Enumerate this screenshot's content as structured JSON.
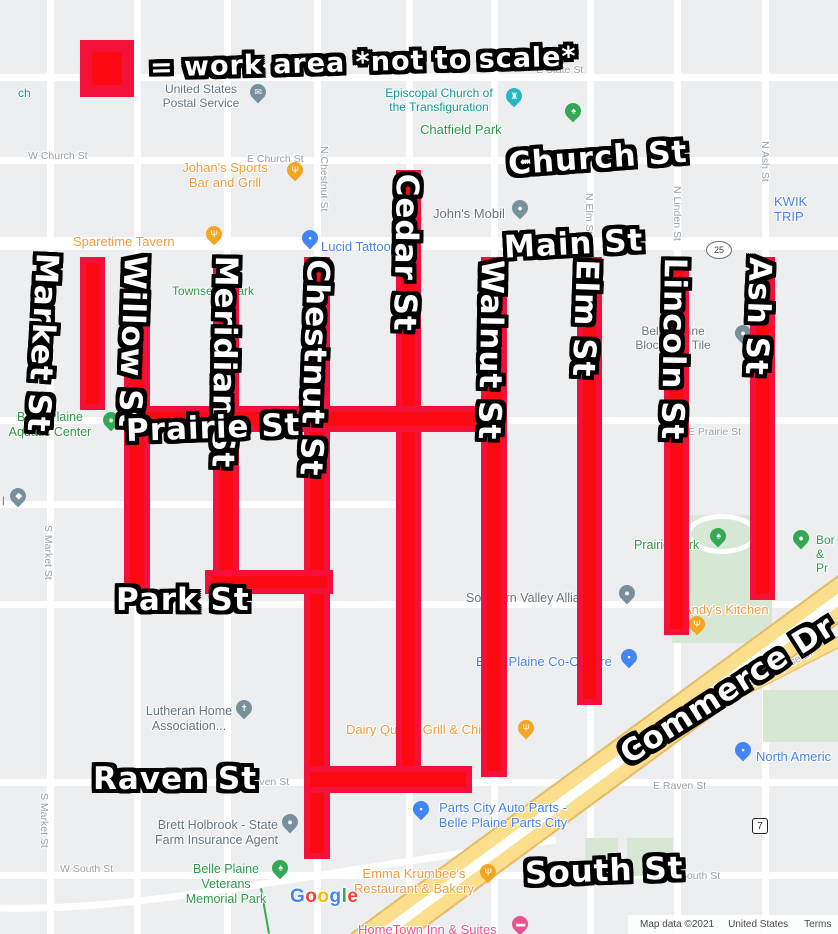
{
  "legend": {
    "text": "= work area *not to scale*"
  },
  "big_labels": {
    "market": "Market St",
    "willow": "Willow St",
    "meridian": "Meridian St",
    "chestnut": "Chestnut St",
    "cedar": "Cedar St",
    "walnut": "Walnut St",
    "elm": "Elm St",
    "lincoln": "Lincoln St",
    "ash": "Ash St",
    "church": "Church St",
    "main": "Main St",
    "prairie": "Prairie St",
    "park": "Park St",
    "raven": "Raven St",
    "south": "South St",
    "commerce": "Commerce Dr"
  },
  "labels": {
    "cut_ch": "ch",
    "chatfield_park": "Chatfield Park",
    "e_state_st": "E State St",
    "usps": "United States\nPostal Service",
    "episcopal": "Episcopal Church of\nthe Transfiguration",
    "w_church_st": "W Church St",
    "e_church_st": "E Church St",
    "johans": "Johan's Sports\nBar and Grill",
    "johns_mobil": "John's Mobil",
    "kwik_trip": "KWIK TRIP",
    "n_chestnut_st": "N Chestnut St",
    "sparetime": "Sparetime Tavern",
    "lucid": "Lucid Tattoo",
    "n_elm_st": "N Elm St",
    "n_linden_st": "N Linden St",
    "n_ash_st": "N Ash St",
    "townsend_park": "Townsend Park",
    "bp_block_tile": "Belle Plaine\nBlock And Tile",
    "bp_aquatic": "Belle Plaine\nAquatic Center",
    "e_prairie_st": "E Prairie St",
    "cut_l": "l",
    "s_market_st": "S Market St",
    "prairie_park": "Prairie Park",
    "borders": "Bor\n& Pr",
    "southern_valley": "Southern Valley Alliance",
    "andys": "Andy's Kitchen",
    "e_enterprise_dr": "E Enterprise Dr",
    "bp_coop": "Belle Plaine Co-Op Tire",
    "lutheran": "Lutheran Home\nAssociation...",
    "dairy_queen": "Dairy Queen Grill & Chill",
    "north_america": "North Americ",
    "e_raven_st": "E Raven St",
    "parts_city": "Parts City Auto Parts -\nBelle Plaine Parts City",
    "brett": "Brett Holbrook - State\nFarm Insurance Agent",
    "w_south_st": "W South St",
    "e_south_st": "E South St",
    "emma": "Emma Krumbee's\nRestaurant & Bakery",
    "vets_park": "Belle Plaine\nVeterans\nMemorial Park",
    "hometown": "HomeTown Inn & Suites"
  },
  "routes": {
    "r25": "25",
    "r7": "7"
  },
  "google_logo": [
    "G",
    "o",
    "o",
    "g",
    "l",
    "e"
  ],
  "attribution": {
    "map_data": "Map data ©2021",
    "region": "United States",
    "terms": "Terms"
  },
  "colors": {
    "work_area_outer": "#f5103a",
    "work_area_inner": "#fb0a12",
    "park_green_fill": "#d6e8d4",
    "highway_yellow": "#fbdf8c",
    "poi_orange": "#f39b3d",
    "poi_blue": "#4683ea",
    "poi_green": "#2c9848",
    "poi_teal": "#0e9594",
    "poi_gray": "#66757f",
    "poi_pink": "#e8538f",
    "street_gray": "#9aa0a6"
  }
}
